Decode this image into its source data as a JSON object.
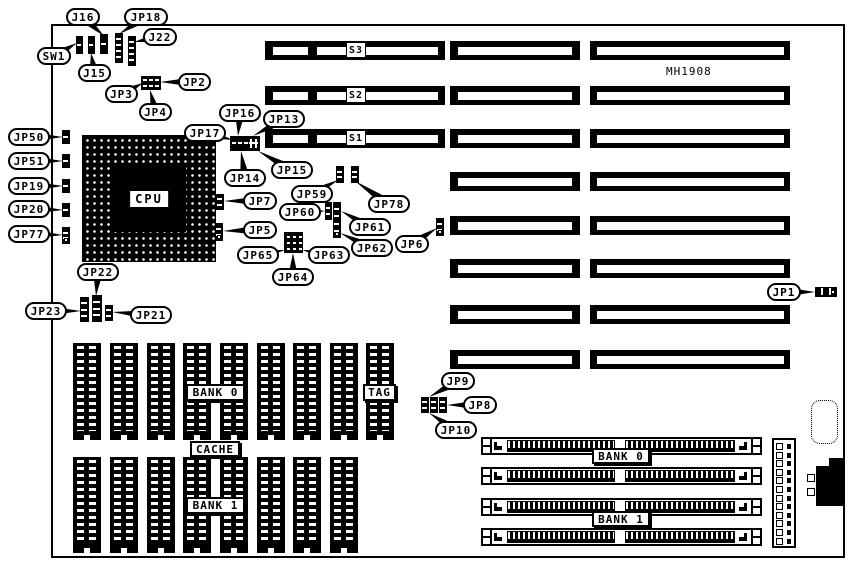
{
  "diagram": {
    "model_text": "MH1908",
    "cpu_label": "CPU",
    "board": {
      "x": 51,
      "y": 24,
      "w": 794,
      "h": 534
    },
    "model_pos": {
      "x": 666,
      "y": 65
    },
    "cpu": {
      "x": 82,
      "y": 135,
      "w": 134,
      "h": 127
    },
    "slots": {
      "labels": [
        "S3",
        "S2",
        "S1"
      ],
      "row_tops": [
        41,
        86,
        129,
        172,
        216,
        259,
        305,
        350
      ],
      "row_height": 19,
      "colA": {
        "x": 265,
        "w": 180,
        "rows": [
          0,
          1,
          2
        ],
        "seg1": {
          "l": 8,
          "w": 35
        },
        "seg2": {
          "l": 52,
          "w": 121
        },
        "label_l": 81,
        "label_w": 20
      },
      "colB": {
        "x": 450,
        "w": 130,
        "stripe_l": 8,
        "stripe_w": 114
      },
      "colC": {
        "x": 590,
        "w": 200,
        "stripe_l": 7,
        "stripe_w": 187
      }
    },
    "chips": {
      "w": 28,
      "rows": [
        {
          "y": 343,
          "h": 97,
          "xs": [
            73,
            110,
            147,
            183,
            220,
            257,
            293,
            330,
            366
          ]
        },
        {
          "y": 457,
          "h": 96,
          "xs": [
            73,
            110,
            147,
            183,
            220,
            257,
            293,
            330
          ]
        }
      ]
    },
    "chip_labels": [
      {
        "text": "BANK 0",
        "x": 186,
        "y": 384,
        "w": 59,
        "h": 17
      },
      {
        "text": "TAG",
        "x": 363,
        "y": 384,
        "w": 33,
        "h": 17
      },
      {
        "text": "CACHE",
        "x": 190,
        "y": 441,
        "w": 50,
        "h": 16
      },
      {
        "text": "BANK 1",
        "x": 186,
        "y": 497,
        "w": 59,
        "h": 17
      }
    ],
    "simms": {
      "x": 481,
      "w": 281,
      "h": 18,
      "ys": [
        437,
        467,
        498,
        528
      ]
    },
    "simm_bank_labels": [
      {
        "text": "BANK 0",
        "x": 592,
        "y": 448,
        "w": 58,
        "h": 16
      },
      {
        "text": "BANK 1",
        "x": 592,
        "y": 511,
        "w": 58,
        "h": 16
      }
    ],
    "power_connector": {
      "x": 772,
      "y": 438,
      "w": 24,
      "h": 110,
      "pins": 12
    },
    "keyboard_footprint": {
      "x": 811,
      "y": 400,
      "w": 27,
      "h": 44
    },
    "din_connector": {
      "body": {
        "x": 816,
        "y": 466,
        "w": 29,
        "h": 40
      },
      "tab": {
        "x": 829,
        "y": 458,
        "w": 16,
        "h": 9
      },
      "sockets": [
        {
          "x": 807,
          "y": 474,
          "w": 8,
          "h": 8
        },
        {
          "x": 807,
          "y": 488,
          "w": 8,
          "h": 8
        }
      ]
    },
    "jumpers": [
      {
        "id": "sw1-header",
        "type": "v",
        "x": 76,
        "y": 36,
        "w": 7,
        "h": 18,
        "cells": 2
      },
      {
        "id": "j15-header",
        "type": "v",
        "x": 88,
        "y": 36,
        "w": 7,
        "h": 18,
        "cells": 2
      },
      {
        "id": "j16-header",
        "type": "v",
        "x": 100,
        "y": 34,
        "w": 8,
        "h": 20,
        "cells": 2
      },
      {
        "id": "jp18-header",
        "type": "v",
        "x": 115,
        "y": 33,
        "w": 8,
        "h": 30,
        "cells": 5
      },
      {
        "id": "j22-header",
        "type": "v",
        "x": 128,
        "y": 36,
        "w": 8,
        "h": 30,
        "cells": 5
      },
      {
        "id": "jp2-jp3-jp4-block",
        "type": "block",
        "x": 141,
        "y": 76,
        "w": 20,
        "h": 14
      },
      {
        "id": "jp17-jp16-jp13-header",
        "type": "header",
        "x": 230,
        "y": 136,
        "w": 30,
        "h": 15
      },
      {
        "id": "jp50-header",
        "type": "v",
        "x": 62,
        "y": 130,
        "w": 8,
        "h": 14,
        "cells": 2
      },
      {
        "id": "jp51-header",
        "type": "v",
        "x": 62,
        "y": 154,
        "w": 8,
        "h": 14,
        "cells": 2
      },
      {
        "id": "jp19-header",
        "type": "v",
        "x": 62,
        "y": 179,
        "w": 8,
        "h": 14,
        "cells": 2
      },
      {
        "id": "jp20-header",
        "type": "v",
        "x": 62,
        "y": 203,
        "w": 8,
        "h": 14,
        "cells": 2
      },
      {
        "id": "jp77-header",
        "type": "v",
        "x": 62,
        "y": 227,
        "w": 8,
        "h": 17,
        "cells": 3,
        "open": true
      },
      {
        "id": "jp7-header",
        "type": "v",
        "x": 216,
        "y": 194,
        "w": 8,
        "h": 16,
        "cells": 3
      },
      {
        "id": "jp5-header",
        "type": "v",
        "x": 215,
        "y": 223,
        "w": 8,
        "h": 18,
        "cells": 3,
        "open": true
      },
      {
        "id": "jp59-header",
        "type": "v",
        "x": 336,
        "y": 166,
        "w": 8,
        "h": 17,
        "cells": 3
      },
      {
        "id": "jp78-header",
        "type": "v",
        "x": 351,
        "y": 166,
        "w": 8,
        "h": 17,
        "cells": 3
      },
      {
        "id": "jp60-header",
        "type": "v",
        "x": 325,
        "y": 202,
        "w": 7,
        "h": 18,
        "cells": 3
      },
      {
        "id": "jp61-jp62-header",
        "type": "v",
        "x": 333,
        "y": 202,
        "w": 8,
        "h": 36,
        "cells": 5,
        "open": true
      },
      {
        "id": "jp65-jp64-jp63-block",
        "type": "grid3",
        "x": 284,
        "y": 232,
        "w": 19,
        "h": 21
      },
      {
        "id": "jp6-header",
        "type": "v",
        "x": 436,
        "y": 218,
        "w": 8,
        "h": 18,
        "cells": 3,
        "open": true
      },
      {
        "id": "jp22-header-a",
        "type": "v",
        "x": 80,
        "y": 297,
        "w": 9,
        "h": 25,
        "cells": 4
      },
      {
        "id": "jp22-header-b",
        "type": "v",
        "x": 92,
        "y": 295,
        "w": 10,
        "h": 27,
        "cells": 4
      },
      {
        "id": "jp21-header",
        "type": "v",
        "x": 105,
        "y": 305,
        "w": 8,
        "h": 16,
        "cells": 3
      },
      {
        "id": "jp9-header-a",
        "type": "v",
        "x": 421,
        "y": 397,
        "w": 8,
        "h": 16,
        "cells": 3
      },
      {
        "id": "jp9-header-b",
        "type": "v",
        "x": 430,
        "y": 397,
        "w": 8,
        "h": 16,
        "cells": 3
      },
      {
        "id": "jp9-header-c",
        "type": "v",
        "x": 439,
        "y": 397,
        "w": 8,
        "h": 16,
        "cells": 3
      },
      {
        "id": "jp1-header",
        "type": "h",
        "x": 815,
        "y": 287,
        "w": 22,
        "h": 10,
        "cells": 3,
        "open": true
      }
    ],
    "callouts": [
      {
        "text": "J16",
        "x": 66,
        "y": 8,
        "w": 34,
        "tx": 104,
        "ty": 36
      },
      {
        "text": "JP18",
        "x": 124,
        "y": 8,
        "w": 44,
        "tx": 119,
        "ty": 34
      },
      {
        "text": "J22",
        "x": 143,
        "y": 28,
        "w": 34,
        "tx": 134,
        "ty": 42
      },
      {
        "text": "SW1",
        "x": 37,
        "y": 47,
        "w": 34,
        "tx": 77,
        "ty": 43
      },
      {
        "text": "J15",
        "x": 78,
        "y": 64,
        "w": 33,
        "tx": 91,
        "ty": 53
      },
      {
        "text": "JP3",
        "x": 105,
        "y": 85,
        "w": 33,
        "tx": 143,
        "ty": 83
      },
      {
        "text": "JP2",
        "x": 178,
        "y": 73,
        "w": 33,
        "tx": 160,
        "ty": 82
      },
      {
        "text": "JP4",
        "x": 139,
        "y": 103,
        "w": 33,
        "tx": 150,
        "ty": 90
      },
      {
        "text": "JP50",
        "x": 8,
        "y": 128,
        "w": 42,
        "tx": 63,
        "ty": 137
      },
      {
        "text": "JP51",
        "x": 8,
        "y": 152,
        "w": 42,
        "tx": 63,
        "ty": 161
      },
      {
        "text": "JP19",
        "x": 8,
        "y": 177,
        "w": 42,
        "tx": 63,
        "ty": 186
      },
      {
        "text": "JP20",
        "x": 8,
        "y": 200,
        "w": 42,
        "tx": 63,
        "ty": 210
      },
      {
        "text": "JP77",
        "x": 8,
        "y": 225,
        "w": 42,
        "tx": 63,
        "ty": 235
      },
      {
        "text": "JP17",
        "x": 184,
        "y": 124,
        "w": 42,
        "tx": 233,
        "ty": 140
      },
      {
        "text": "JP16",
        "x": 219,
        "y": 104,
        "w": 42,
        "tx": 238,
        "ty": 136
      },
      {
        "text": "JP13",
        "x": 263,
        "y": 110,
        "w": 42,
        "tx": 253,
        "ty": 136
      },
      {
        "text": "JP14",
        "x": 224,
        "y": 169,
        "w": 42,
        "tx": 241,
        "ty": 151
      },
      {
        "text": "JP15",
        "x": 271,
        "y": 161,
        "w": 42,
        "tx": 258,
        "ty": 151
      },
      {
        "text": "JP59",
        "x": 291,
        "y": 185,
        "w": 42,
        "tx": 338,
        "ty": 180
      },
      {
        "text": "JP78",
        "x": 368,
        "y": 195,
        "w": 42,
        "tx": 355,
        "ty": 181
      },
      {
        "text": "JP7",
        "x": 243,
        "y": 192,
        "w": 34,
        "tx": 224,
        "ty": 201
      },
      {
        "text": "JP60",
        "x": 279,
        "y": 203,
        "w": 42,
        "tx": 325,
        "ty": 211
      },
      {
        "text": "JP61",
        "x": 349,
        "y": 218,
        "w": 42,
        "tx": 341,
        "ty": 211
      },
      {
        "text": "JP5",
        "x": 243,
        "y": 221,
        "w": 34,
        "tx": 223,
        "ty": 231
      },
      {
        "text": "JP62",
        "x": 351,
        "y": 239,
        "w": 42,
        "tx": 340,
        "ty": 233
      },
      {
        "text": "JP63",
        "x": 308,
        "y": 246,
        "w": 42,
        "tx": 302,
        "ty": 250
      },
      {
        "text": "JP65",
        "x": 237,
        "y": 246,
        "w": 42,
        "tx": 285,
        "ty": 250
      },
      {
        "text": "JP64",
        "x": 272,
        "y": 268,
        "w": 42,
        "tx": 293,
        "ty": 253
      },
      {
        "text": "JP6",
        "x": 395,
        "y": 235,
        "w": 34,
        "tx": 437,
        "ty": 228
      },
      {
        "text": "JP22",
        "x": 77,
        "y": 263,
        "w": 42,
        "tx": 96,
        "ty": 296
      },
      {
        "text": "JP23",
        "x": 25,
        "y": 302,
        "w": 42,
        "tx": 81,
        "ty": 311
      },
      {
        "text": "JP21",
        "x": 130,
        "y": 306,
        "w": 42,
        "tx": 112,
        "ty": 312
      },
      {
        "text": "JP1",
        "x": 767,
        "y": 283,
        "w": 34,
        "tx": 815,
        "ty": 292
      },
      {
        "text": "JP9",
        "x": 441,
        "y": 372,
        "w": 34,
        "tx": 429,
        "ty": 397
      },
      {
        "text": "JP8",
        "x": 463,
        "y": 396,
        "w": 34,
        "tx": 447,
        "ty": 405
      },
      {
        "text": "JP10",
        "x": 435,
        "y": 421,
        "w": 42,
        "tx": 429,
        "ty": 413
      }
    ]
  }
}
